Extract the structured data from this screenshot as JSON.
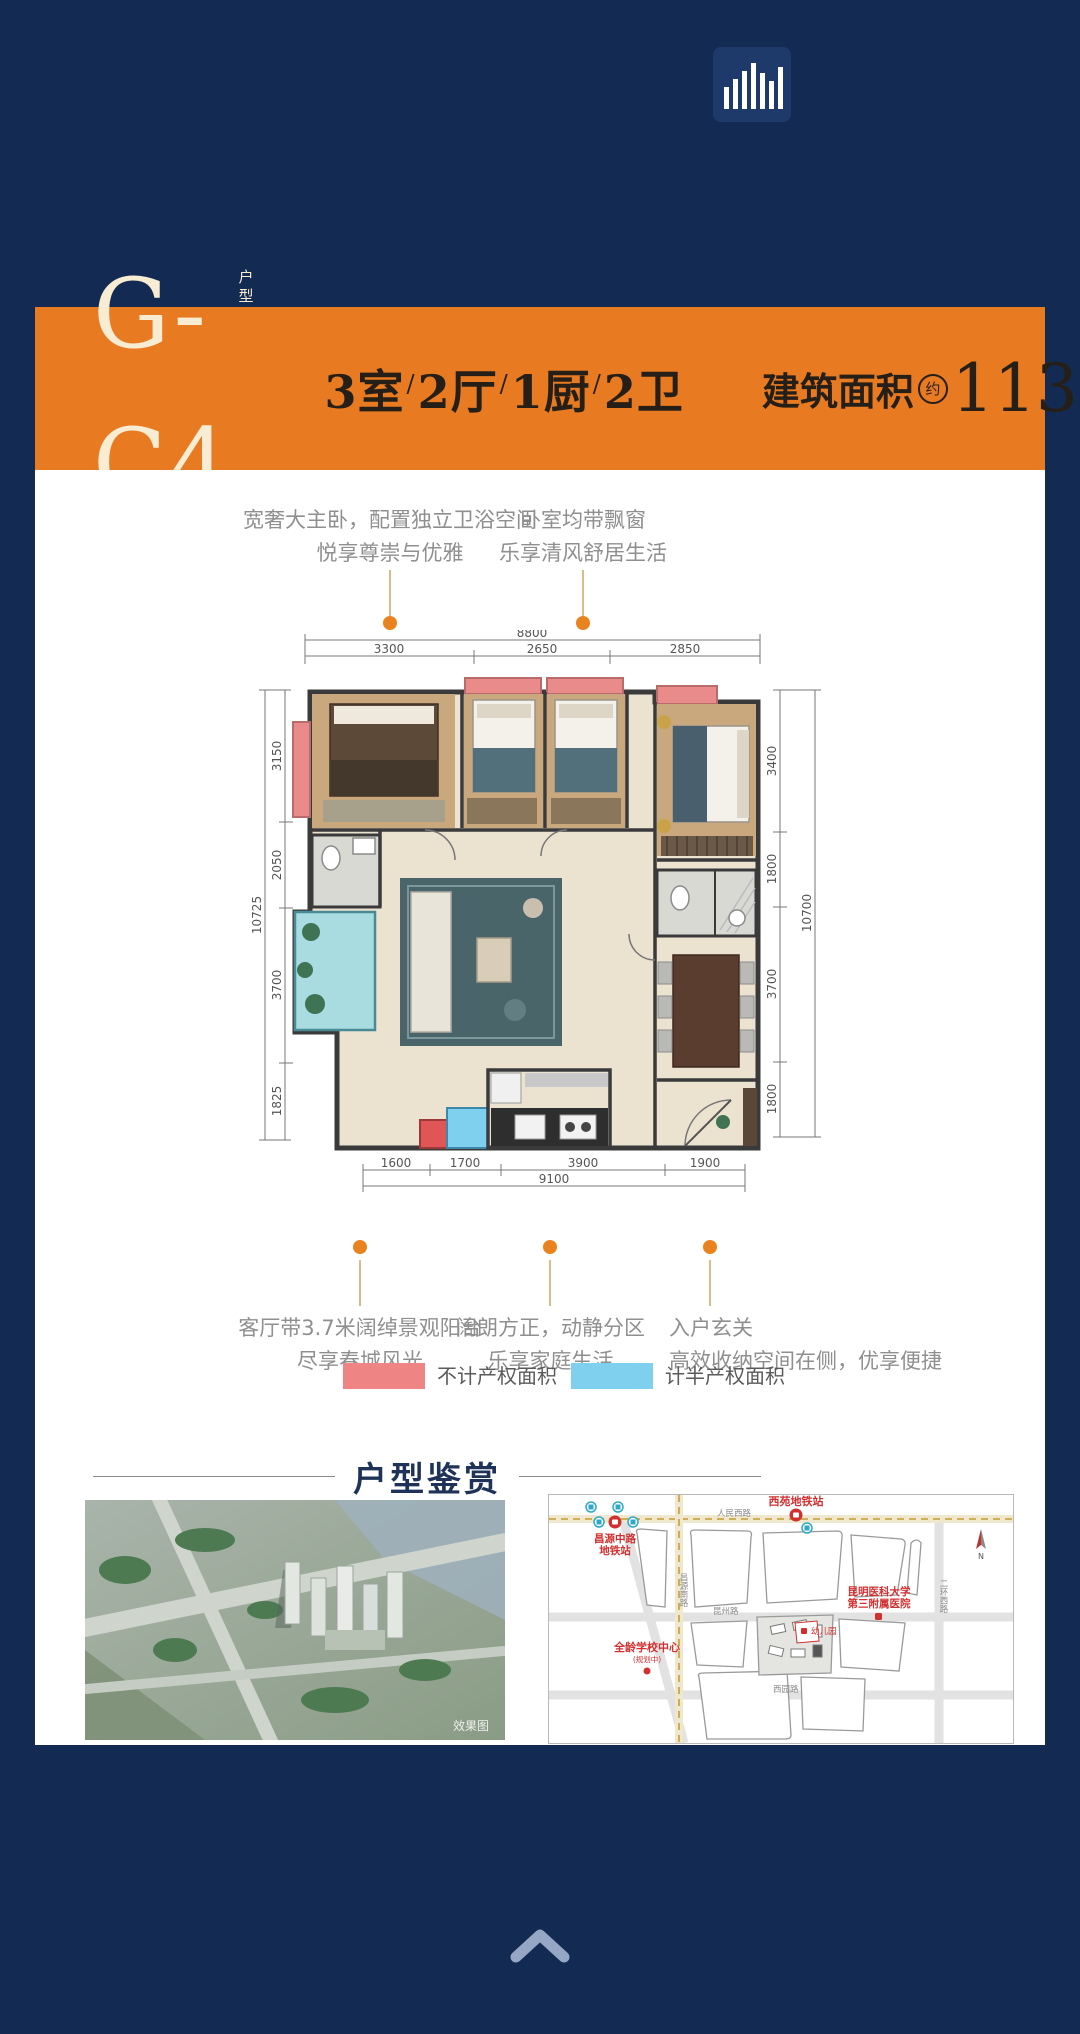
{
  "banner": {
    "unit_code": "G-C4",
    "unit_tag": "户型",
    "rooms": "3室",
    "halls": "2厅",
    "kitchens": "1厨",
    "baths": "2卫",
    "slash": "/",
    "area_label": "建筑面积",
    "area_approx": "约",
    "area_value": "113m",
    "area_exp": "2"
  },
  "top_callouts": [
    {
      "line1": "宽奢大主卧，配置独立卫浴空间",
      "line2": "悦享尊崇与优雅"
    },
    {
      "line1": "卧室均带飘窗",
      "line2": "乐享清风舒居生活"
    }
  ],
  "bottom_callouts": [
    {
      "line1": "客厅带3.7米阔绰景观阳台",
      "line2": "尽享春城风光"
    },
    {
      "line1": "阔朗方正，动静分区",
      "line2": "乐享家庭生活"
    },
    {
      "line1": "入户玄关",
      "line2": "高效收纳空间在侧，优享便捷"
    }
  ],
  "dimensions": {
    "top": {
      "total": "8800",
      "segments": [
        "3300",
        "2650",
        "2850"
      ]
    },
    "left": {
      "total": "10725",
      "segments": [
        "3150",
        "2050",
        "3700",
        "1825"
      ]
    },
    "right": {
      "total": "10700",
      "segments": [
        "3400",
        "1800",
        "3700",
        "1800"
      ]
    },
    "bottom": {
      "total": "9100",
      "segments": [
        "1600",
        "1700",
        "3900",
        "1900"
      ]
    }
  },
  "legend": [
    {
      "label": "不计产权面积",
      "color": "#ee8484"
    },
    {
      "label": "计半产权面积",
      "color": "#7fd0ee"
    }
  ],
  "gallery": {
    "title": "户型鉴赏",
    "watermark": "效果图"
  },
  "map": {
    "station_right": "西苑地铁站",
    "station_left_line1": "昌源中路",
    "station_left_line2": "地铁站",
    "hospital_line1": "昆明医科大学",
    "hospital_line2": "第三附属医院",
    "school": "全龄学校中心",
    "school_note": "(规划中)",
    "kindergarten": "幼儿园",
    "road_top": "人民西路",
    "road_center_v": "昌源南路",
    "road_middle": "昆州路",
    "road_bottom": "西园路",
    "road_right_v": "二环西路",
    "compass": "N"
  }
}
